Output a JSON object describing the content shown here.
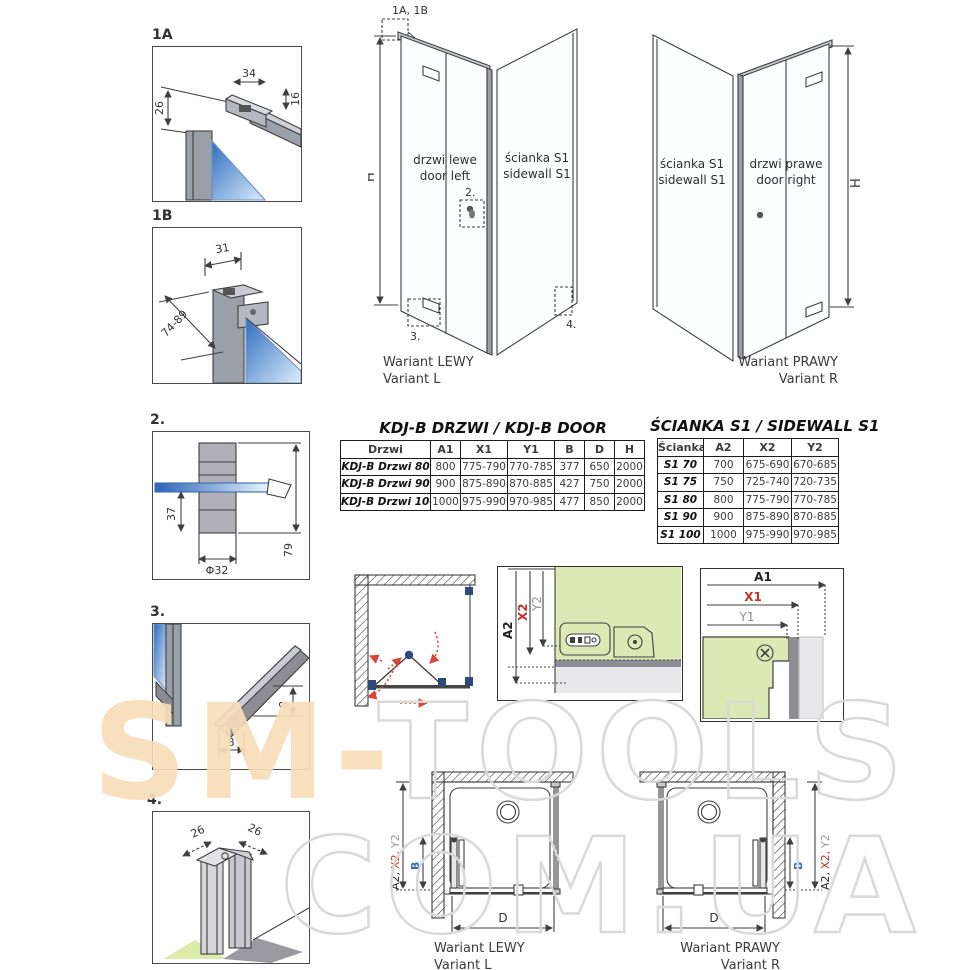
{
  "details": {
    "d1a": {
      "label": "1A",
      "dim_top": "34",
      "dim_side": "16",
      "dim_drop": "26"
    },
    "d1b": {
      "label": "1B",
      "dim_top": "31",
      "dim_diag": "74-89"
    },
    "d2": {
      "label": "2.",
      "dim_inner": "37",
      "dim_dia": "Φ32",
      "dim_outer": "79"
    },
    "d3": {
      "label": "3.",
      "dim_v": "8",
      "dim_h": "8"
    },
    "d4": {
      "label": "4.",
      "dim_left": "26",
      "dim_right": "26"
    }
  },
  "iso_left": {
    "callout_profiles": "1A, 1B",
    "dim_height": "H",
    "door_line1": "drzwi lewe",
    "door_line2": "door left",
    "wall_line1": "ścianka S1",
    "wall_line2": "sidewall S1",
    "callout_knob": "2.",
    "callout_seal": "3.",
    "callout_corner": "4.",
    "caption_line1": "Wariant LEWY",
    "caption_line2": "Variant L"
  },
  "iso_right": {
    "dim_height": "H",
    "wall_line1": "ścianka S1",
    "wall_line2": "sidewall S1",
    "door_line1": "drzwi prawe",
    "door_line2": "door right",
    "caption_line1": "Wariant PRAWY",
    "caption_line2": "Variant R"
  },
  "door_table": {
    "title": "KDJ-B  DRZWI / KDJ-B DOOR",
    "headers": [
      "Drzwi",
      "A1",
      "X1",
      "Y1",
      "B",
      "D",
      "H"
    ],
    "rows": [
      [
        "KDJ-B Drzwi 80",
        "800",
        "775-790",
        "770-785",
        "377",
        "650",
        "2000"
      ],
      [
        "KDJ-B Drzwi 90",
        "900",
        "875-890",
        "870-885",
        "427",
        "750",
        "2000"
      ],
      [
        "KDJ-B Drzwi 100",
        "1000",
        "975-990",
        "970-985",
        "477",
        "850",
        "2000"
      ]
    ]
  },
  "sidewall_table": {
    "title": "ŚCIANKA S1 / SIDEWALL S1",
    "headers": [
      "Ścianka",
      "A2",
      "X2",
      "Y2"
    ],
    "rows": [
      [
        "S1 70",
        "700",
        "675-690",
        "670-685"
      ],
      [
        "S1 75",
        "750",
        "725-740",
        "720-735"
      ],
      [
        "S1 80",
        "800",
        "775-790",
        "770-785"
      ],
      [
        "S1 90",
        "900",
        "875-890",
        "870-885"
      ],
      [
        "S1 100",
        "1000",
        "975-990",
        "970-985"
      ]
    ]
  },
  "section_sidewall": {
    "dim_a": "A2",
    "dim_x": "X2",
    "dim_y": "Y2"
  },
  "section_door": {
    "dim_a": "A1",
    "dim_x": "X1",
    "dim_y": "Y1"
  },
  "plan_left": {
    "a2": "A2,",
    "x2": "X2,",
    "y2": "Y2",
    "b": "B",
    "d": "D",
    "caption_line1": "Wariant LEWY",
    "caption_line2": "Variant L"
  },
  "plan_right": {
    "a2": "A2,",
    "x2": "X2,",
    "y2": "Y2",
    "b": "B",
    "d": "D",
    "caption_line1": "Wariant PRAWY",
    "caption_line2": "Variant R"
  },
  "watermark": {
    "part1": "SM-",
    "part2": "TOOLS",
    "line2": "COM.UA"
  },
  "colors": {
    "accent_red": "#c13528",
    "accent_blue": "#3a6ab8",
    "accent_purple": "#4b3a96",
    "dim_gray": "#909090",
    "glass_blue": "#2e6dc0",
    "green_fill": "#dde9b5",
    "watermark_beige": "#f7dcb8",
    "watermark_outline": "#d9d9d9"
  }
}
